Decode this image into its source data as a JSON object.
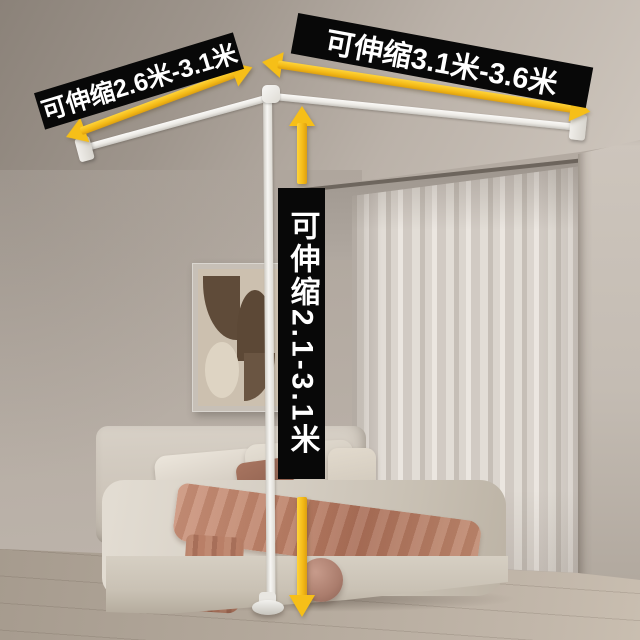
{
  "image": {
    "type": "product-annotation-photo",
    "scene": "bedroom with white telescopic L-shaped canopy rod frame",
    "objects": [
      "ceiling",
      "left-wall",
      "curtain-alcove",
      "sheer-curtain",
      "right-wall",
      "wood-floor",
      "wall-art",
      "bed",
      "headboard",
      "pillows",
      "accent-pillow",
      "duvet",
      "throw-blanket",
      "pouf",
      "rod-left-segment",
      "rod-right-segment",
      "vertical-pole",
      "wall-brackets",
      "floor-base"
    ]
  },
  "annotations": {
    "right_rod": {
      "text": "可伸缩3.1米-3.6米"
    },
    "left_rod": {
      "text": "可伸缩2.6米-3.1米"
    },
    "vertical_pole": {
      "text": "可伸缩2.1-3.1米"
    }
  },
  "icons": {
    "right_rod_arrow": "double-headed-arrow",
    "left_rod_arrow": "double-headed-arrow",
    "pole_arrow_up": "arrow-up",
    "pole_arrow_down": "arrow-down"
  },
  "colors": {
    "banner_background": "#080808",
    "banner_text": "#ffffff",
    "arrow_yellow": "#f6bf18",
    "rod_white": "#f3f1ed",
    "wall_greige": "#b3aaa1",
    "ceiling": "#a59c93",
    "curtain": "#d9d4cd",
    "floor_wood": "#b7ab9e",
    "bed_cream": "#d8d2c7",
    "blanket_terracotta": "#bd8269",
    "accent_pillow": "#9a6854",
    "pouf": "#ab7d6d"
  }
}
